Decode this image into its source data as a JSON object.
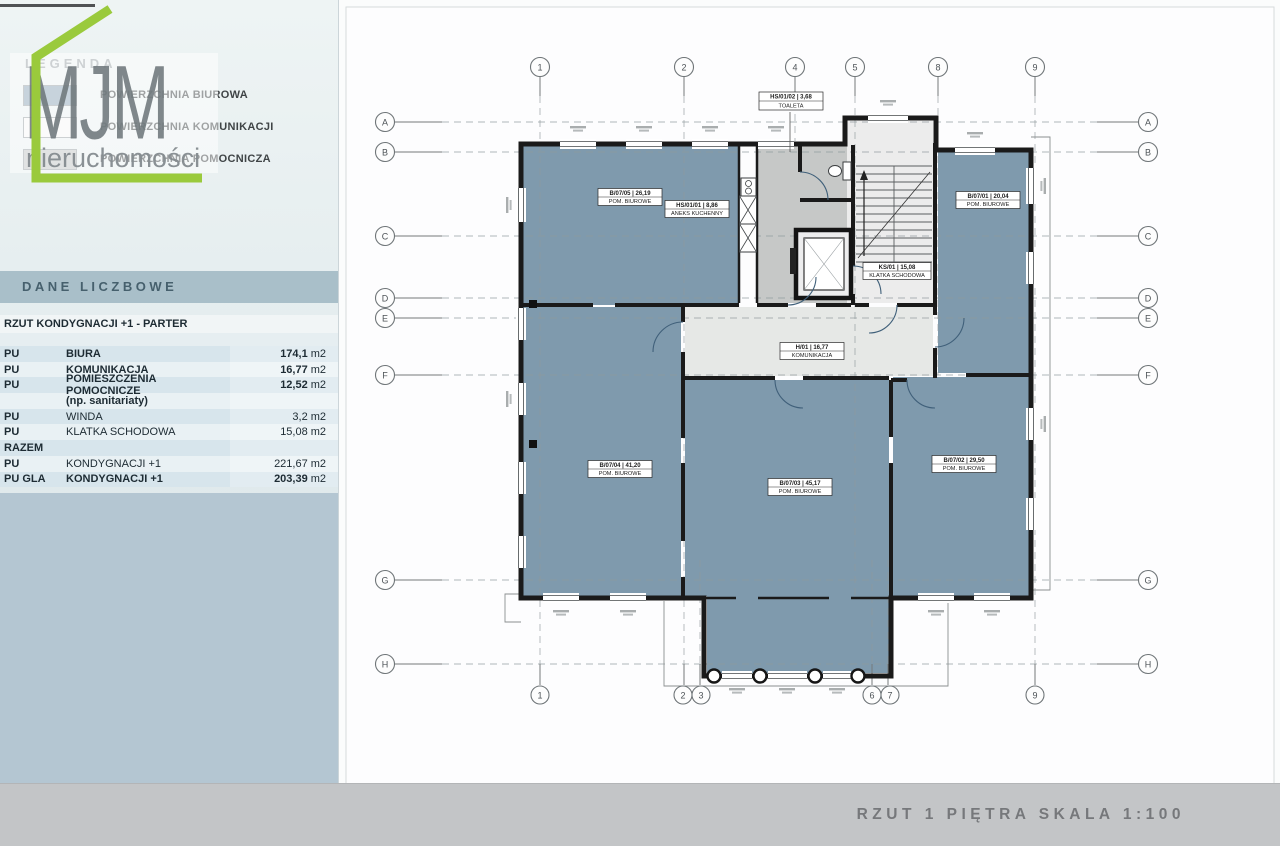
{
  "page": {
    "footer_title": "RZUT 1 PIĘTRA SKALA 1:100",
    "colors": {
      "room_fill": "#7f9aad",
      "corridor_fill": "#e6e8e6",
      "aux_fill": "#c6c8c7",
      "accent_green": "#9aca3c",
      "sidebar_block": "#b4c6d2",
      "footer_band": "#c3c5c7"
    }
  },
  "branding": {
    "logo_line1": "MJM",
    "logo_line2": "nieruchomości"
  },
  "legend": {
    "title": "LEGENDA",
    "items": [
      {
        "label": "POWIERZCHNIA BIUROWA",
        "color": "#8ea7b8"
      },
      {
        "label": "POWIERZCHNIA KOMUNIKACJI",
        "color": "#f6f7f7"
      },
      {
        "label": "POWIERZCHNIA POMOCNICZA",
        "color": "#c3c6c7"
      }
    ]
  },
  "table": {
    "title": "DANE LICZBOWE",
    "section": "RZUT KONDYGNACJI +1 - PARTER",
    "rows": [
      {
        "c1": "PU",
        "c2": "BIURA",
        "v": "174,1",
        "u": "m2"
      },
      {
        "c1": "PU",
        "c2": "KOMUNIKACJA",
        "v": "16,77",
        "u": "m2"
      },
      {
        "c1": "PU",
        "c2": "POMIESZCZENIA POMOCNICZE",
        "v": "12,52",
        "u": "m2"
      },
      {
        "c1": "",
        "c2": "(np. sanitariaty)",
        "v": "",
        "u": ""
      },
      {
        "c1": "PU",
        "c2": "WINDA",
        "v": "3,2",
        "u": "m2"
      },
      {
        "c1": "PU",
        "c2": "KLATKA SCHODOWA",
        "v": "15,08",
        "u": "m2"
      },
      {
        "c1": "RAZEM",
        "c2": "",
        "v": "",
        "u": ""
      },
      {
        "c1": "PU",
        "c2": "KONDYGNACJI +1",
        "v": "221,67",
        "u": "m2"
      },
      {
        "c1": "PU GLA",
        "c2": "KONDYGNACJI +1",
        "v": "203,39",
        "u": "m2"
      }
    ]
  },
  "plan": {
    "grid": {
      "top": [
        "1",
        "2",
        "4",
        "5",
        "8",
        "9"
      ],
      "bottom": [
        "1",
        "2",
        "3",
        "6",
        "7",
        "9"
      ],
      "left": [
        "A",
        "B",
        "C",
        "D",
        "E",
        "F",
        "G",
        "H"
      ],
      "right": [
        "A",
        "B",
        "C",
        "D",
        "E",
        "F",
        "G",
        "H"
      ]
    },
    "rooms": [
      {
        "line1": "B/07/05 | 26,19",
        "line2": "POM. BIUROWE"
      },
      {
        "line1": "HS/01/01 | 8,86",
        "line2": "ANEKS KUCHENNY"
      },
      {
        "line1": "HS/01/02 | 3,68",
        "line2": "TOALETA"
      },
      {
        "line1": "B/07/01 | 20,04",
        "line2": "POM. BIUROWE"
      },
      {
        "line1": "KS/01 | 15,08",
        "line2": "KLATKA SCHODOWA"
      },
      {
        "line1": "H/01 | 16,77",
        "line2": "KOMUNIKACJA"
      },
      {
        "line1": "B/07/04 | 41,20",
        "line2": "POM. BIUROWE"
      },
      {
        "line1": "B/07/03 | 45,17",
        "line2": "POM. BIUROWE"
      },
      {
        "line1": "B/07/02 | 29,50",
        "line2": "POM. BIUROWE"
      }
    ]
  }
}
